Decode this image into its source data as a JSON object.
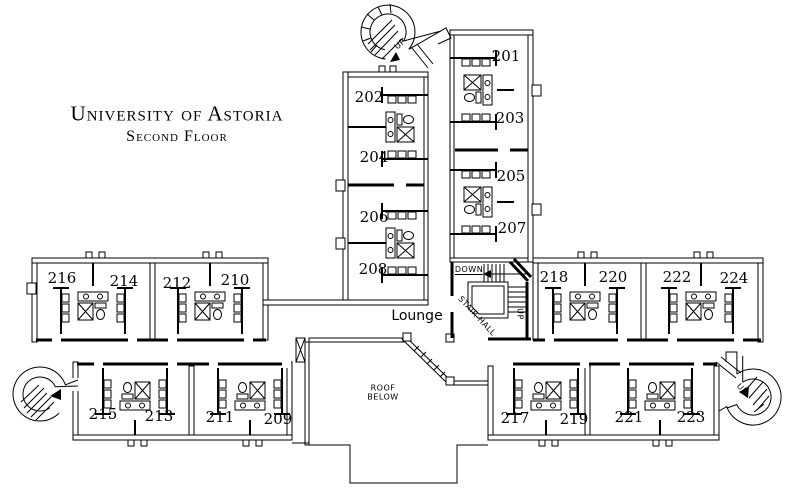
{
  "title": {
    "line1": "University of Astoria",
    "line2": "Second Floor"
  },
  "rooms": {
    "r201": "201",
    "r202": "202",
    "r203": "203",
    "r204": "204",
    "r205": "205",
    "r206": "206",
    "r207": "207",
    "r208": "208",
    "r209": "209",
    "r210": "210",
    "r211": "211",
    "r212": "212",
    "r213": "213",
    "r214": "214",
    "r215": "215",
    "r216": "216",
    "r217": "217",
    "r218": "218",
    "r219": "219",
    "r220": "220",
    "r221": "221",
    "r222": "222",
    "r223": "223",
    "r224": "224"
  },
  "labels": {
    "lounge": "Lounge",
    "stair_hall": "STAIR HALL",
    "down": "DOWN",
    "up_stair_hall": "UP",
    "up_north_stair": "UP",
    "up_east_stair": "UP",
    "roof_line1": "ROOF",
    "roof_line2": "BELOW"
  },
  "colors": {
    "ink": "#000000",
    "paper": "#ffffff"
  }
}
